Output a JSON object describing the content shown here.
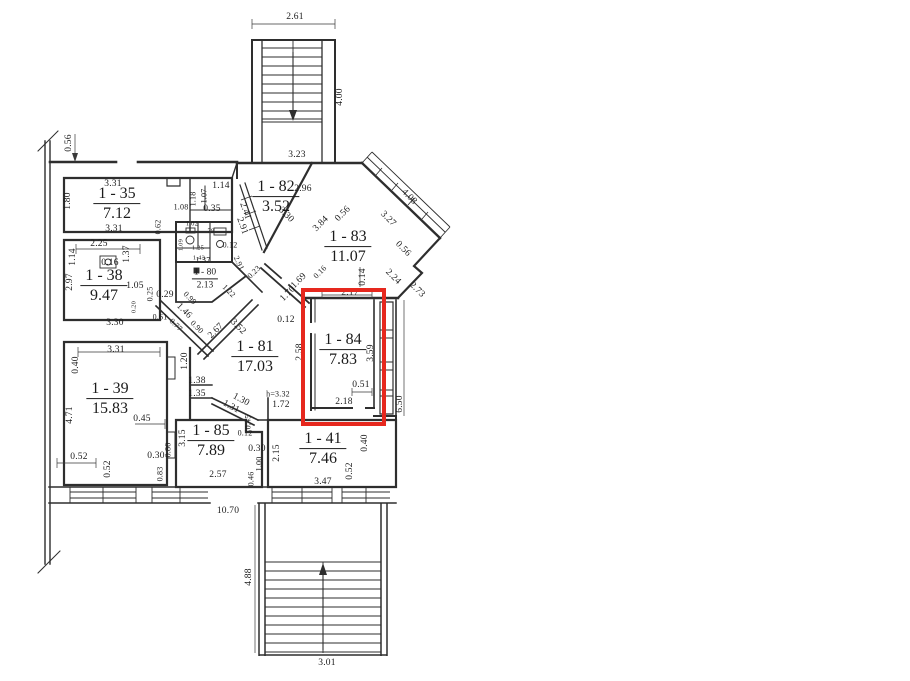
{
  "colors": {
    "highlight": "#e6281e",
    "line": "#2e2e2e"
  },
  "highlight": {
    "room_id": "1 - 84"
  },
  "rooms": {
    "r35": {
      "id": "1 - 35",
      "area": "7.12"
    },
    "r38": {
      "id": "1 - 38",
      "area": "9.47"
    },
    "r39": {
      "id": "1 - 39",
      "area": "15.83"
    },
    "r81": {
      "id": "1 - 81",
      "area": "17.03"
    },
    "r82": {
      "id": "1 - 82",
      "area": "3.52"
    },
    "r83": {
      "id": "1 - 83",
      "area": "11.07"
    },
    "r84": {
      "id": "1 - 84",
      "area": "7.83"
    },
    "r85": {
      "id": "1 - 85",
      "area": "7.89"
    },
    "r41": {
      "id": "1 - 41",
      "area": "7.46"
    },
    "r80": {
      "id": "1 - 80",
      "area": "2.13"
    }
  },
  "dims": [
    "2.61",
    "4.00",
    "3.23",
    "0.56",
    "3.31",
    "1.80",
    "3.31",
    "1.14",
    "1.18",
    "1.07",
    "0.35",
    "1.08",
    "0.62",
    "2.25",
    "1.14",
    "2.97",
    "0.16",
    "1.37",
    "1.05",
    "0.25",
    "0.29",
    "0.20",
    "0.61",
    "3.30",
    "1.02",
    "79",
    "1.09",
    "1.25",
    "1.43",
    "0.12",
    "2.91",
    "1.37",
    "0.23",
    "1.22",
    "0.99",
    "1.46",
    "0.77",
    "0.90",
    "2.67",
    "3.52",
    "2.96",
    "2.41",
    "2.91",
    "3.30",
    "3.84",
    "0.56",
    "4.08",
    "3.27",
    "0.56",
    "2.24",
    "2.73",
    "0.14",
    "0.16",
    "1.69",
    "1.70",
    "2.17",
    "0.12",
    "2.58",
    "3.59",
    "0.51",
    "2.18",
    "6.50",
    "1.20",
    "1.38",
    "1.35",
    "1.31",
    "1.30",
    "h=3.32",
    "1.72",
    "3.31",
    "0.40",
    "4.71",
    "0.45",
    "0.52",
    "0.52",
    "0.30",
    "0.80",
    "0.83",
    "3.15",
    "2.57",
    "0.12",
    "0.30",
    "1.00",
    "0.46",
    "0.45",
    "2.15",
    "3.47",
    "0.40",
    "0.52",
    "10.70",
    "4.88",
    "3.01"
  ]
}
